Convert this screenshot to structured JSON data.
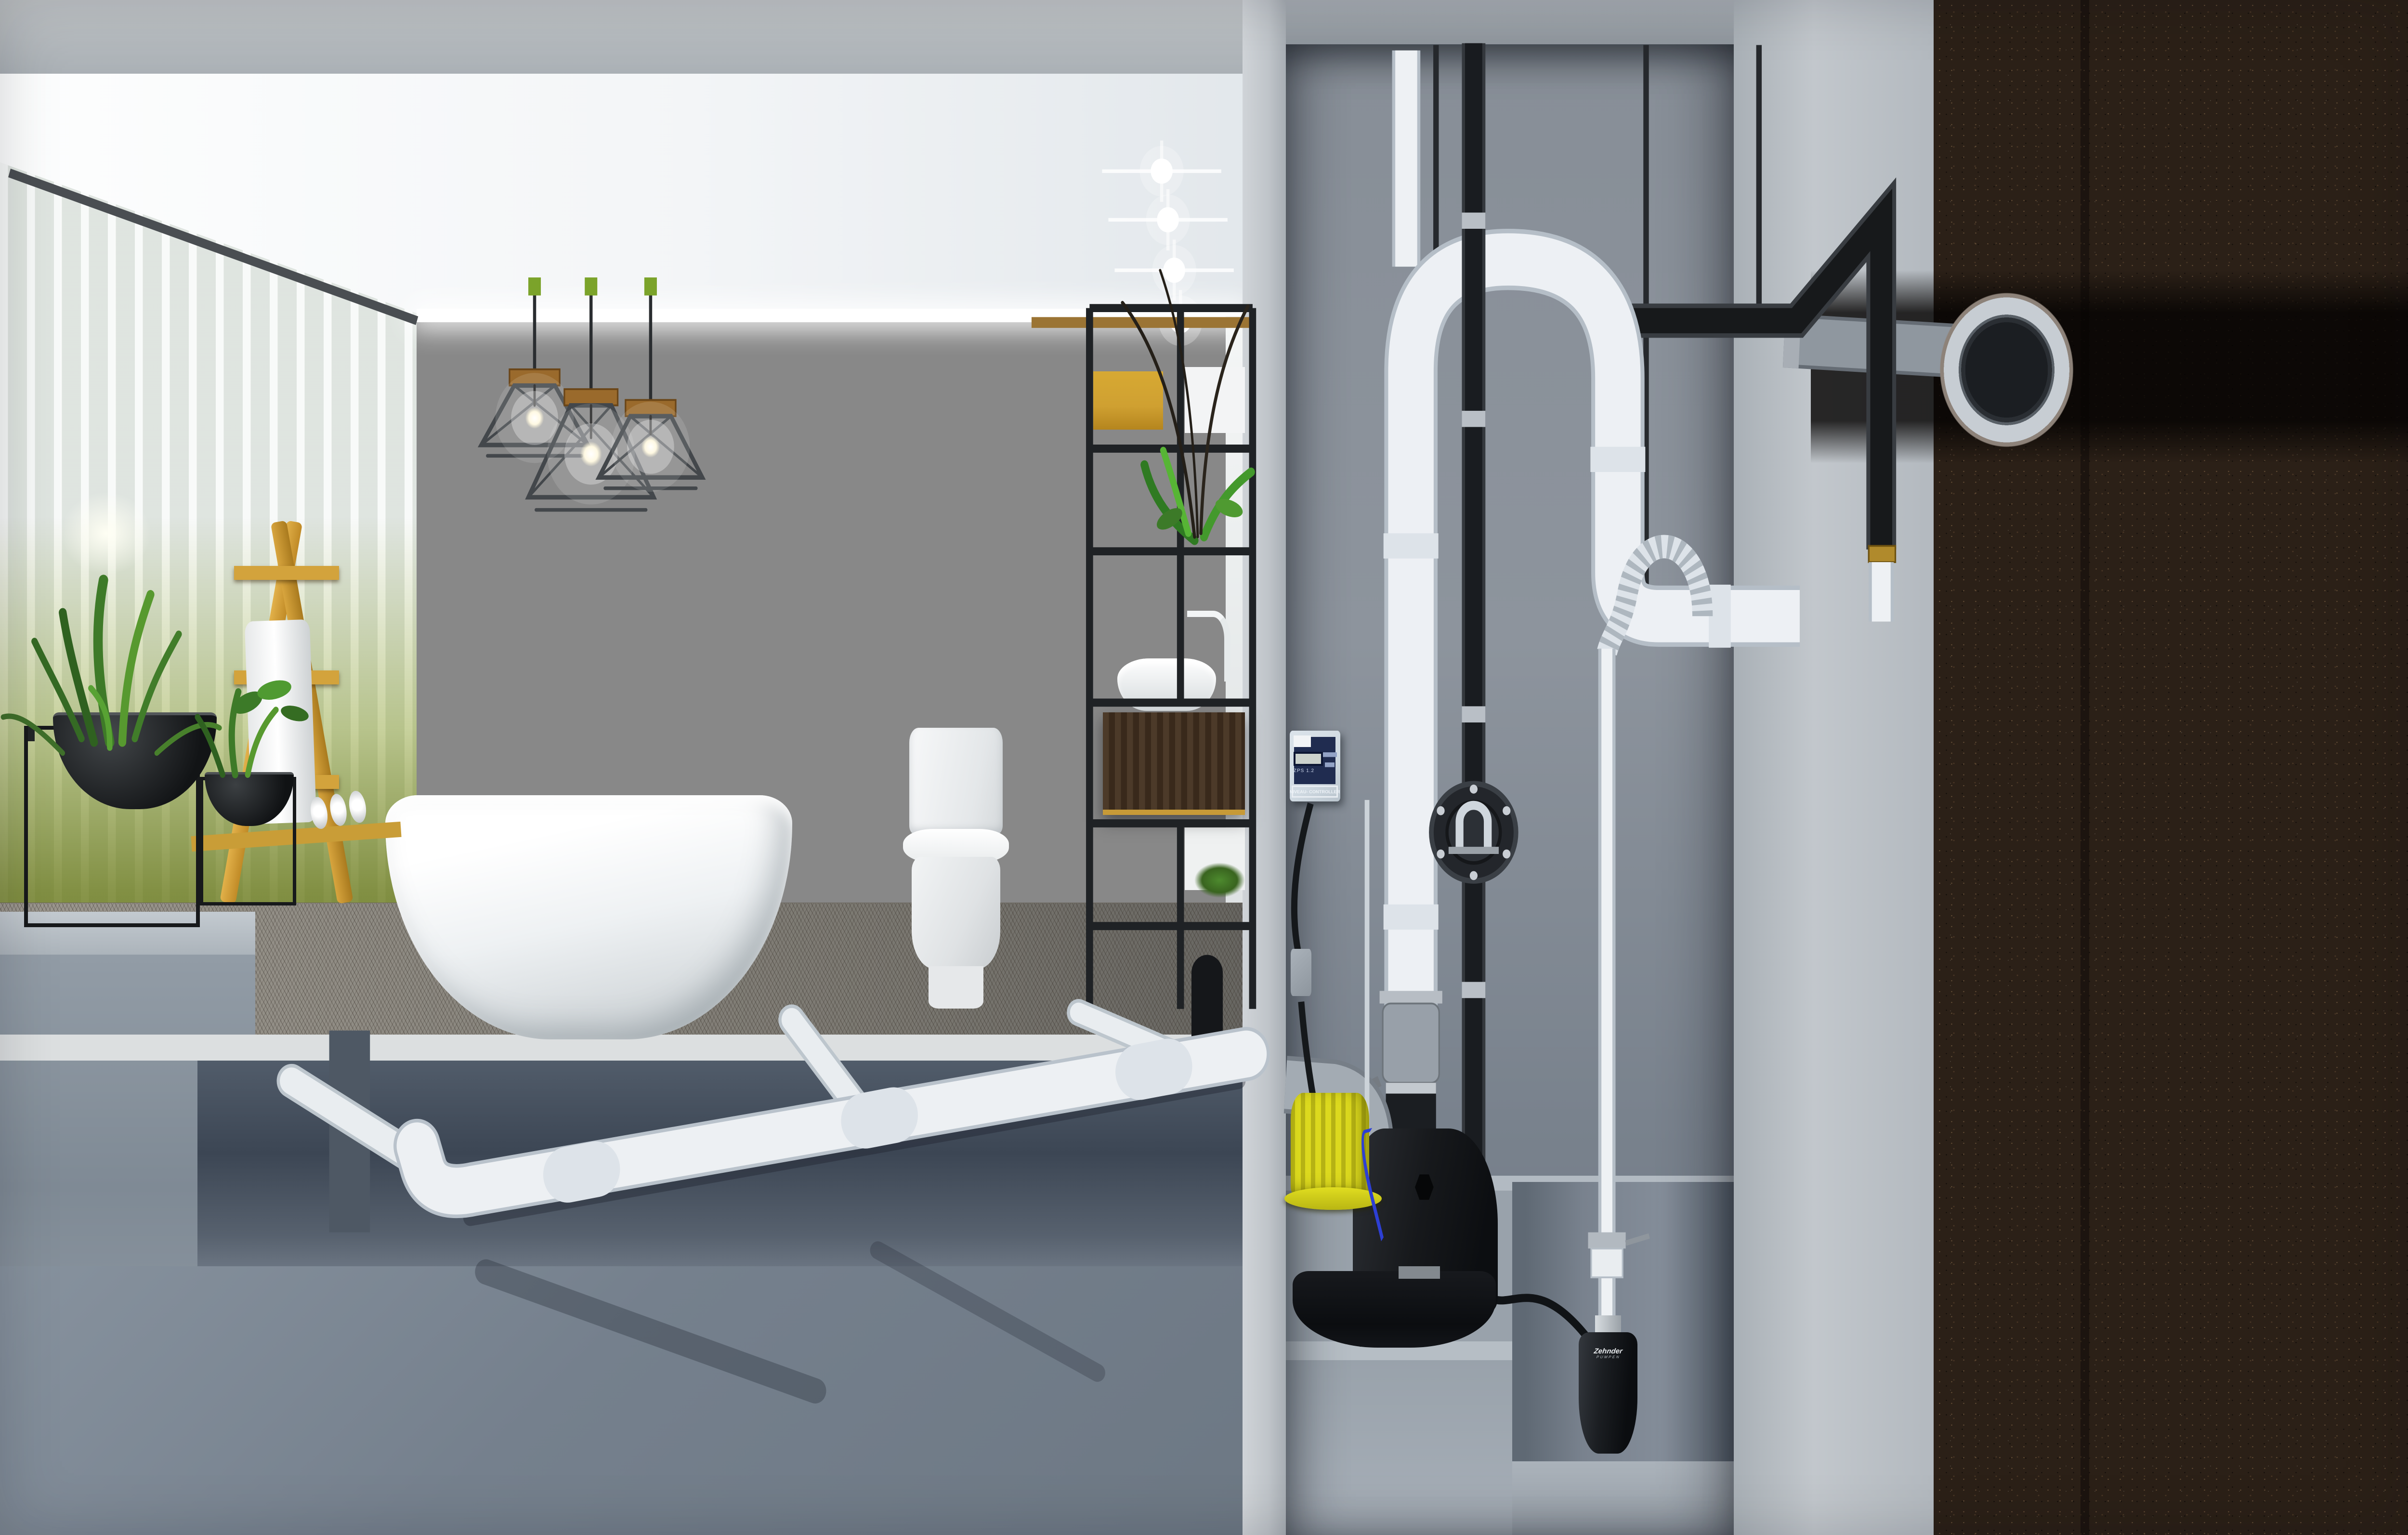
{
  "controller": {
    "model": "ZPS 1.2",
    "title": "NIVEAU- CONTROLLER"
  },
  "sump_pump": {
    "brand": "Zehnder",
    "brand_sub": "PUMPEN"
  },
  "colors": {
    "ceiling": "#f3f5f7",
    "wall": "#c4c7c9",
    "concrete-light": "#c6cbcf",
    "concrete-mid": "#99a1a9",
    "concrete-blue": "#76808d",
    "soil": "#2b2017",
    "soil-dark": "#120d09",
    "pipe-white": "#eef1f4",
    "pipe-outline": "#b5bec7",
    "pipe-gray": "#a3abb3",
    "pipe-black": "#17191b",
    "pump-yellow": "#dcd91e",
    "tank-black": "#141619",
    "hose-blue": "#2d3fd4",
    "water-green": "#3d5a2a",
    "olive-glass": "#7d9026",
    "plant-green": "#3f7d2c",
    "ladder-wood": "#d0a140",
    "vanity-wood": "#46362a",
    "panel-yellow": "#cfa031",
    "controller-navy": "#202c50",
    "controller-body": "#cfd9e1",
    "metal": "#c6ccd2"
  },
  "objects": [
    "slatted-glass-wall",
    "sun-glow",
    "board-formed-concrete-wall",
    "cove-light",
    "recessed-downlights",
    "cage-pendant-lights",
    "freestanding-bathtub",
    "toilet",
    "vanity-with-vessel-sink",
    "metal-shelf-frame",
    "yellow-wood-panel",
    "wooden-ladder",
    "towel",
    "rolled-towels",
    "plant-bowls-on-stands",
    "herringbone-floor",
    "underfloor-drain-pipe",
    "branch-drain-pipes",
    "toilet-drop-pipe",
    "utility-shaft",
    "level-controller",
    "wall-socket",
    "sewage-lifting-station",
    "lifting-station-motor",
    "discharge-gate-valve",
    "discharge-loop-pipe",
    "vent-pipe",
    "pressure-pipe",
    "check-valve",
    "flexible-hose",
    "sump-riser-pipe",
    "riser-check-valve",
    "submersible-sump-pump",
    "threaded-support-rods",
    "outlet-pipe-to-sewer",
    "sewer-pipe-cross-section",
    "waste-water",
    "soil-cross-section",
    "excavation-trench"
  ]
}
